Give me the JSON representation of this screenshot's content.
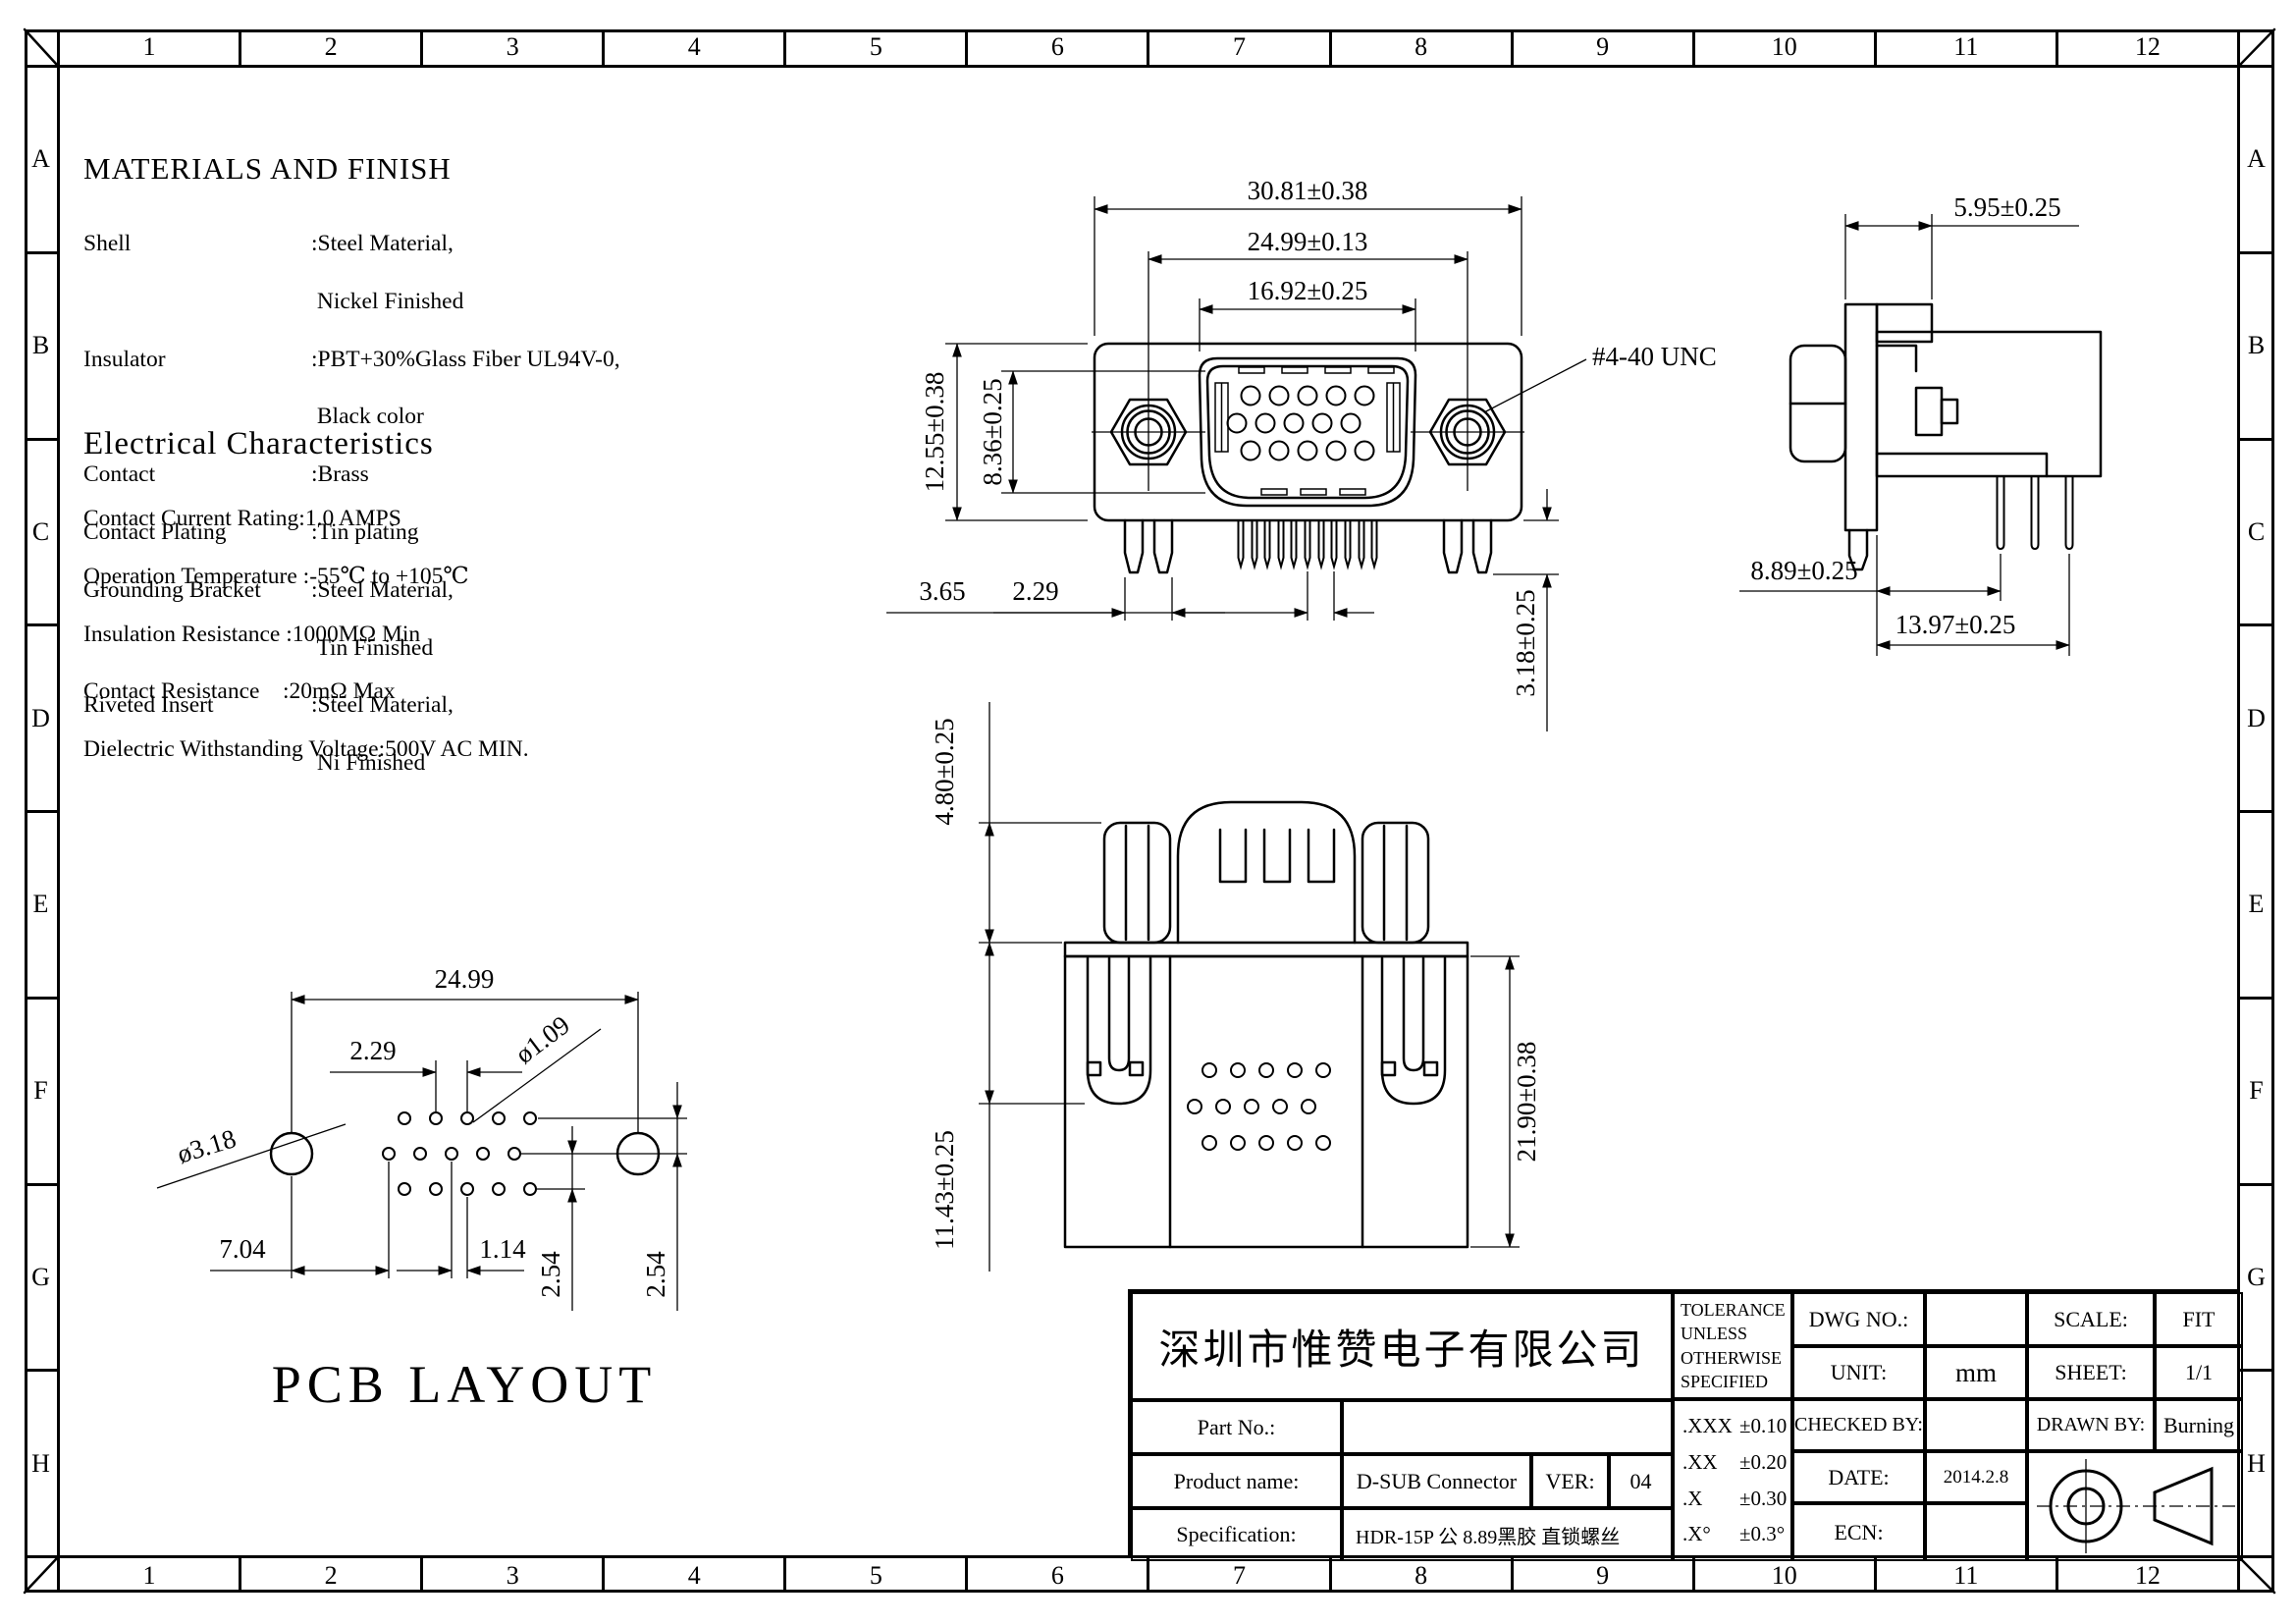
{
  "grid": {
    "cols": [
      "1",
      "2",
      "3",
      "4",
      "5",
      "6",
      "7",
      "8",
      "9",
      "10",
      "11",
      "12"
    ],
    "rows": [
      "A",
      "B",
      "C",
      "D",
      "E",
      "F",
      "G",
      "H"
    ]
  },
  "materials": {
    "title": "MATERIALS AND FINISH",
    "rows": [
      {
        "label": "Shell",
        "value": ":Steel Material,"
      },
      {
        "label": "",
        "value": " Nickel Finished"
      },
      {
        "label": "Insulator",
        "value": ":PBT+30%Glass Fiber UL94V-0,"
      },
      {
        "label": "",
        "value": " Black color"
      },
      {
        "label": "Contact",
        "value": ":Brass"
      },
      {
        "label": "Contact Plating",
        "value": ":Tin plating"
      },
      {
        "label": "Grounding Bracket",
        "value": ":Steel Material,"
      },
      {
        "label": "",
        "value": " Tin Finished"
      },
      {
        "label": "Riveted Insert",
        "value": ":Steel Material,"
      },
      {
        "label": "",
        "value": " Ni Finished"
      }
    ]
  },
  "electrical": {
    "title": "Electrical Characteristics",
    "lines": [
      "Contact Current Rating:1.0 AMPS",
      "Operation Temperature :-55℃ to +105℃",
      "Insulation Resistance :1000MΩ Min",
      "Contact Resistance    :20mΩ Max",
      "Dielectric Withstanding Voltage:500V AC MIN."
    ]
  },
  "views": {
    "front": {
      "d_3081": "30.81±0.38",
      "d_2499": "24.99±0.13",
      "d_1692": "16.92±0.25",
      "d_1255": "12.55±0.38",
      "d_836": "8.36±0.25",
      "d_365": "3.65",
      "d_229": "2.29",
      "d_318": "3.18±0.25",
      "thread": "#4-40 UNC"
    },
    "side": {
      "d_595": "5.95±0.25",
      "d_889": "8.89±0.25",
      "d_1397": "13.97±0.25"
    },
    "plan": {
      "d_480": "4.80±0.25",
      "d_1143": "11.43±0.25",
      "d_2190": "21.90±0.38"
    },
    "pcb": {
      "title": "PCB LAYOUT",
      "d_2499": "24.99",
      "d_229": "2.29",
      "d_109": "ø1.09",
      "d_318": "ø3.18",
      "d_704": "7.04",
      "d_114": "1.14",
      "d_254a": "2.54",
      "d_254b": "2.54"
    }
  },
  "titleblock": {
    "company": "深圳市惟赞电子有限公司",
    "part_no_label": "Part No.:",
    "part_no_value": "",
    "product_label": "Product name:",
    "product_value": "D-SUB Connector",
    "ver_label": "VER:",
    "ver_value": "04",
    "spec_label": "Specification:",
    "spec_value": "HDR-15P 公 8.89黑胶 直锁螺丝",
    "tol_header": [
      "TOLERANCE",
      "UNLESS",
      "OTHERWISE",
      "SPECIFIED"
    ],
    "tol": [
      {
        "k": ".XXX",
        "v": "±0.10"
      },
      {
        "k": ".XX",
        "v": "±0.20"
      },
      {
        "k": ".X",
        "v": "±0.30"
      },
      {
        "k": ".X°",
        "v": "±0.3°"
      }
    ],
    "dwg_label": "DWG NO.:",
    "dwg_value": "",
    "unit_label": "UNIT:",
    "unit_value": "mm",
    "checked_label": "CHECKED BY:",
    "checked_value": "",
    "date_label": "DATE:",
    "date_value": "2014.2.8",
    "ecn_label": "ECN:",
    "ecn_value": "",
    "scale_label": "SCALE:",
    "scale_value": "FIT",
    "sheet_label": "SHEET:",
    "sheet_value": "1/1",
    "drawn_label": "DRAWN BY:",
    "drawn_value": "Burning"
  }
}
